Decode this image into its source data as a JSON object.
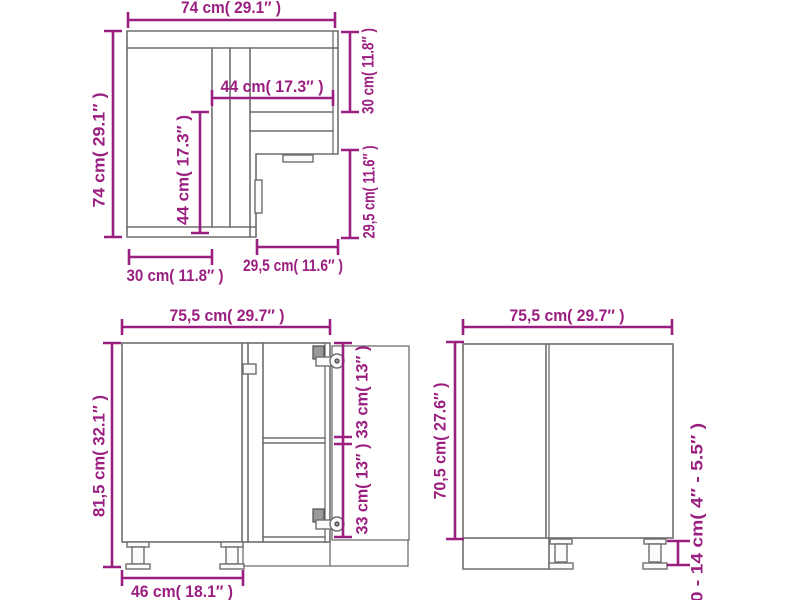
{
  "figure": {
    "type": "furniture-dimension-diagram",
    "views": [
      "top-view",
      "front-view",
      "side-view"
    ]
  },
  "colors": {
    "dimension": "#9b1f80",
    "line": "#6e6e6e",
    "background": "#ffffff"
  },
  "labels": {
    "top_width": "74 cm( 29.1″ )",
    "top_left_height": "74 cm( 29.1″ )",
    "top_right_depth": "30 cm( 11.8″ )",
    "top_inner_width": "44 cm( 17.3″ )",
    "top_inner_depth": "44 cm( 17.3″ )",
    "top_right_lower": "29,5 cm( 11.6″ )",
    "top_bottom_left": "30 cm( 11.8″ )",
    "top_bottom_right": "29,5 cm( 11.6″ )",
    "front_width": "75,5 cm( 29.7″ )",
    "front_height": "81,5 cm( 32.1″ )",
    "front_upper_compartment": "33 cm( 13″ )",
    "front_lower_compartment": "33 cm( 13″ )",
    "front_base_width": "46 cm( 18.1″ )",
    "side_width": "75,5 cm( 29.7″ )",
    "side_height": "70,5 cm( 27.6″ )",
    "side_leg_height": "10 - 14 cm( 4″ - 5.5″ )"
  }
}
